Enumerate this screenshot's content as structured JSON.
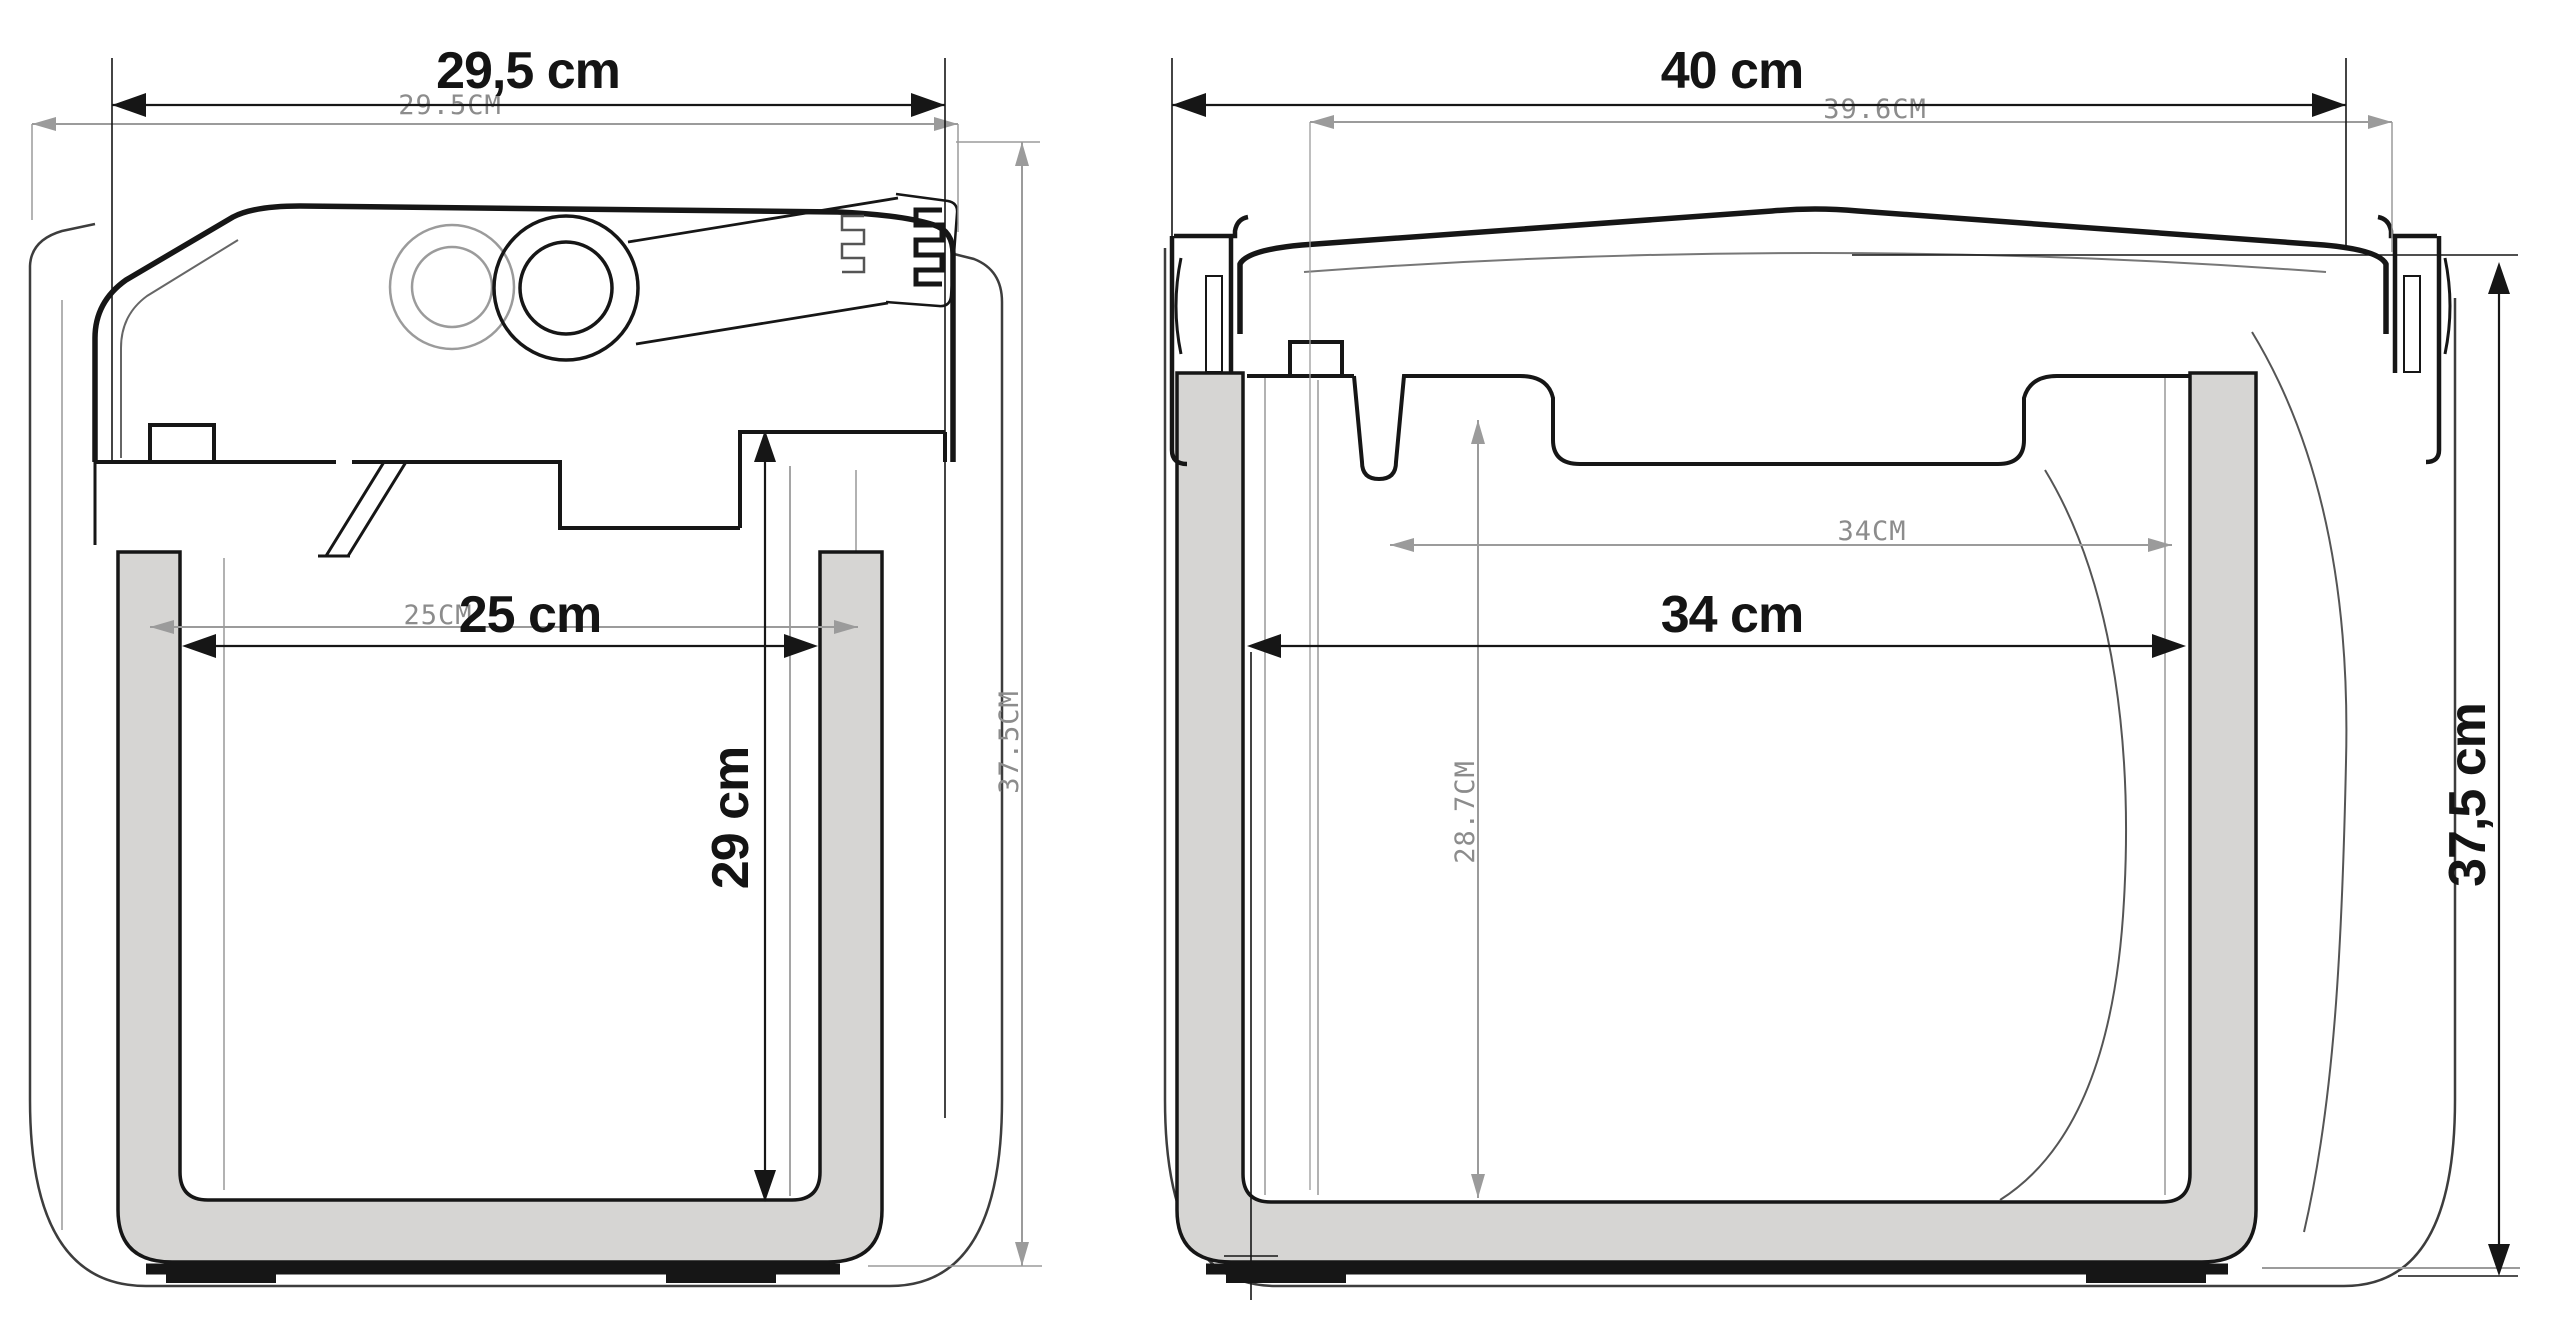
{
  "colors": {
    "outline": "#161616",
    "silhouette": "#3d3d3d",
    "cad_grey": "#8c8c8c",
    "wall_fill": "#d6d5d3",
    "background": "#ffffff"
  },
  "front_view": {
    "outer_width_label": "29,5 cm",
    "outer_width_cad_label": "29.5CM",
    "inner_width_label": "25 cm",
    "inner_width_cad_label": "25CM",
    "inner_height_label": "29 cm",
    "outer_height_cad_label": "37.5CM"
  },
  "side_view": {
    "outer_width_label": "40 cm",
    "outer_width_cad_label": "39.6CM",
    "inner_width_label": "34 cm",
    "inner_width_cad_label": "34CM",
    "inner_height_cad_label": "28.7CM",
    "outer_height_label": "37,5 cm"
  }
}
